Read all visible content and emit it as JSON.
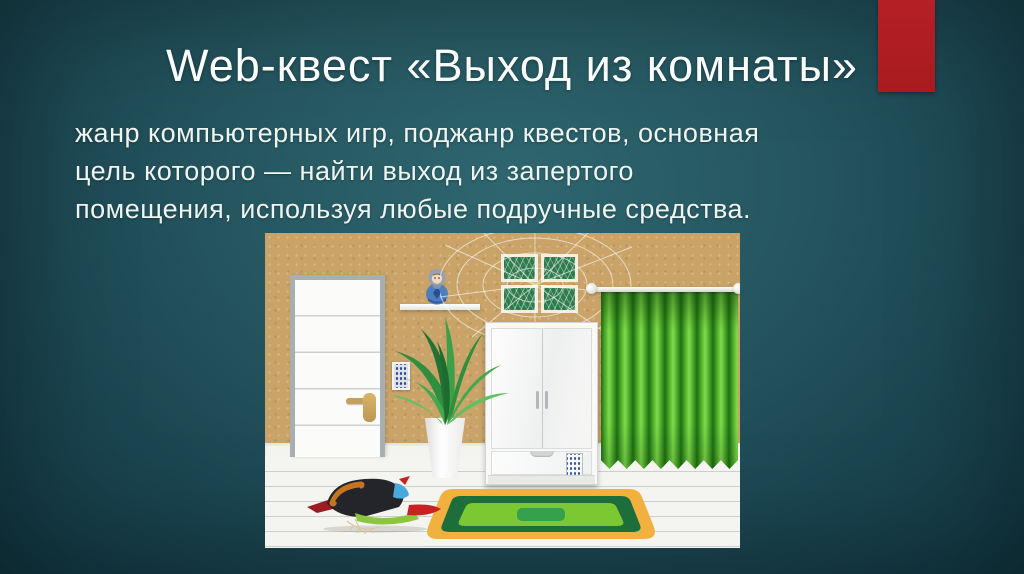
{
  "slide": {
    "title": "Web-квест «Выход из комнаты»",
    "body_lines": [
      "жанр компьютерных игр, поджанр квестов, основная",
      "цель которого — найти выход из запертого",
      "помещения, используя любые подручные средства."
    ],
    "accent_bar_color": "#b42025",
    "background_center_color": "#2e666f",
    "background_edge_color": "#123641",
    "title_color": "#fbfdfd",
    "body_color": "#eef5f1"
  },
  "illustration": {
    "alt": "Комната квеста: белая дверь с кодовой панелью, полка с матрёшкой, пальма в горшке, белый шкаф с кодовым замком, четыре зелёные картины в паутине, зелёная штора на карнизе, зелёный ковёр и птица на белом полу",
    "colors": {
      "wall": "#c9a368",
      "floor": "#f4f4f1",
      "curtain_green": "#58b832",
      "rug_border_orange": "#f2b13e",
      "rug_dark_green": "#1e6e3c",
      "rug_light_green": "#7cc832"
    }
  }
}
